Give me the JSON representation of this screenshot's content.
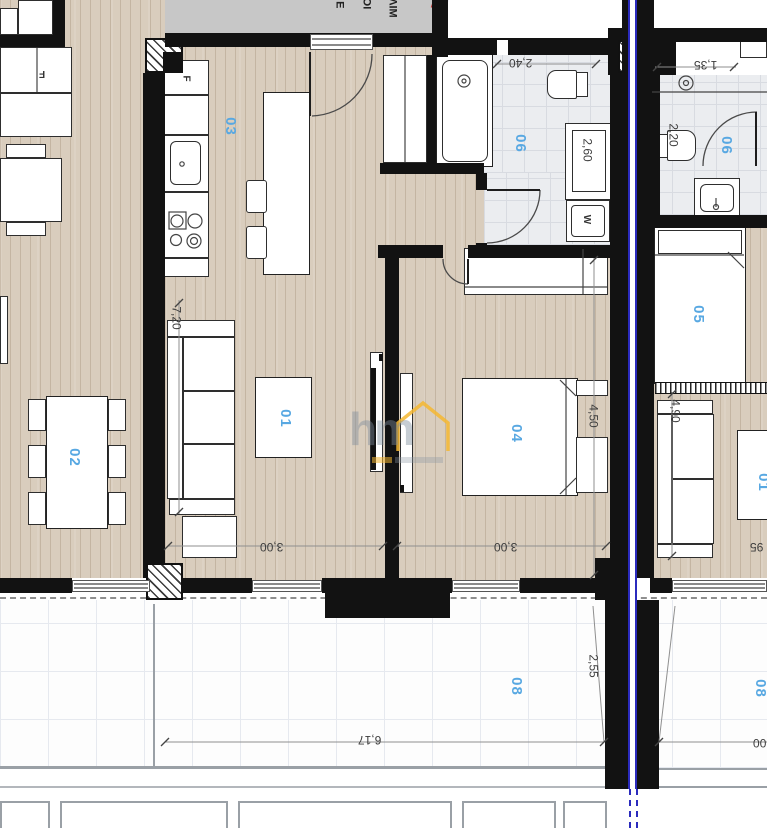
{
  "plan_type": "apartment-floor-plan",
  "colors": {
    "wall": "#121212",
    "wood_floor": "#d9cdbd",
    "tile_floor": "#ebedf0",
    "room_label_blue": "#58a8e2",
    "axis_blue": "#2b2bbd",
    "logo_yellow": "#f4b731",
    "stairwell_gray": "#c7c7c7"
  },
  "room_labels": {
    "r01": "01",
    "r02": "02",
    "r03": "03",
    "r04": "04",
    "r05": "05",
    "r06a": "06",
    "r06b": "06",
    "r08a": "08",
    "r08b": "08",
    "r01b": "01"
  },
  "dimensions": {
    "d720": "7,20",
    "d240": "2,40",
    "d135": "1,35",
    "d220": "2,20",
    "d260": "2,60",
    "d450": "4,50",
    "d490": "4,90",
    "d255": "2,55",
    "d300a": "3,00",
    "d300b": "3,00",
    "d617": "6,17",
    "d95": "95",
    "d00": "00"
  },
  "fixtures": {
    "fridge_a": "F",
    "fridge_b": "F",
    "washer": "W"
  },
  "stairwell": {
    "line1": "ΚΛΙΜ",
    "line2": "ΚΟΙ",
    "line3": "◄Ε"
  },
  "watermark": {
    "logo": "hm"
  }
}
